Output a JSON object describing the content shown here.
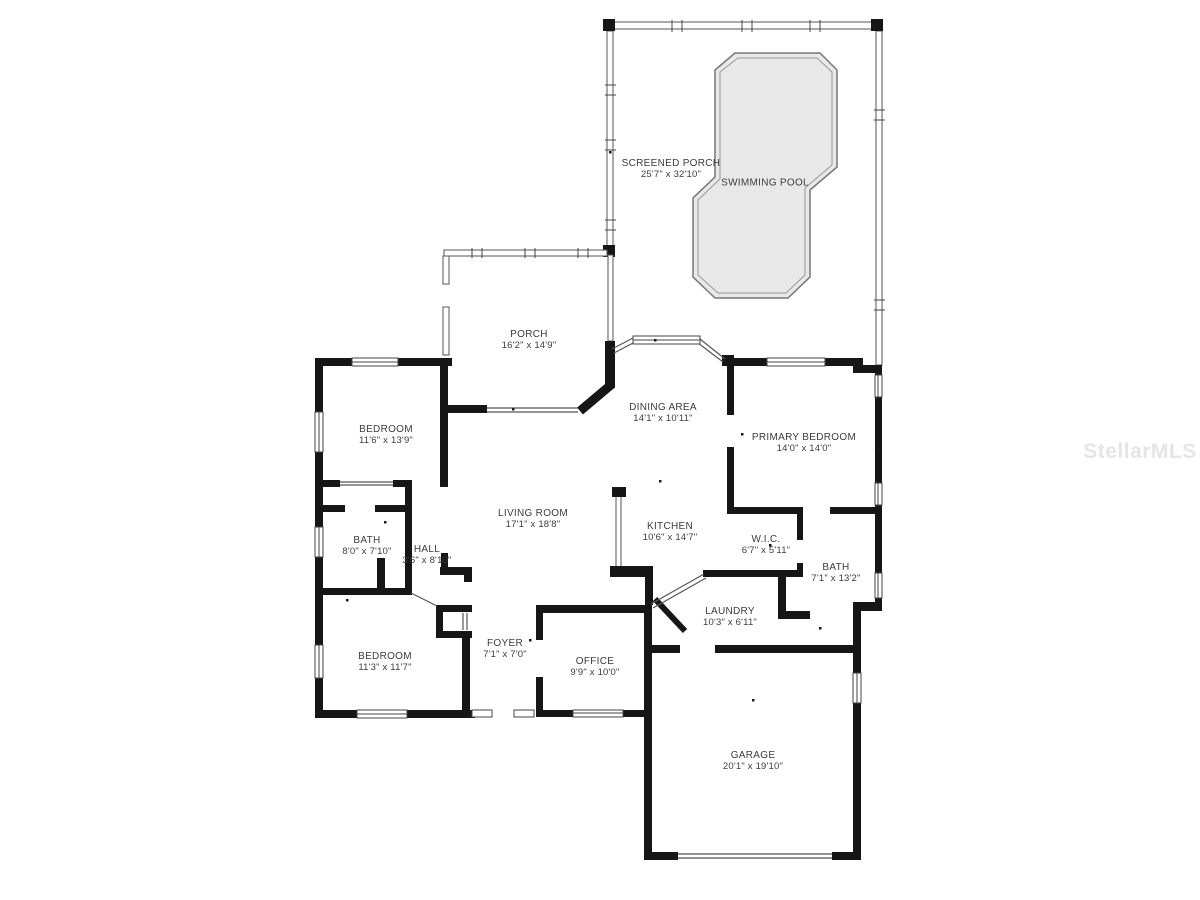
{
  "watermark": "StellarMLS",
  "colors": {
    "wall": "#161616",
    "pool_fill": "#e8e8e8",
    "label_text": "#3c3c3c"
  },
  "rooms": [
    {
      "name": "SCREENED PORCH",
      "dims": "25'7\" x 32'10\""
    },
    {
      "name": "SWIMMING POOL",
      "dims": ""
    },
    {
      "name": "PORCH",
      "dims": "16'2\" x 14'9\""
    },
    {
      "name": "DINING AREA",
      "dims": "14'1\" x 10'11\""
    },
    {
      "name": "PRIMARY BEDROOM",
      "dims": "14'0\" x 14'0\""
    },
    {
      "name": "BEDROOM",
      "dims": "11'6\" x 13'9\""
    },
    {
      "name": "LIVING ROOM",
      "dims": "17'1\" x 18'8\""
    },
    {
      "name": "KITCHEN",
      "dims": "10'6\" x 14'7\""
    },
    {
      "name": "BATH",
      "dims": "8'0\" x 7'10\""
    },
    {
      "name": "HALL",
      "dims": "3'6\" x 8'10\""
    },
    {
      "name": "W.I.C.",
      "dims": "6'7\" x 5'11\""
    },
    {
      "name": "BATH",
      "dims": "7'1\" x 13'2\""
    },
    {
      "name": "LAUNDRY",
      "dims": "10'3\" x 6'11\""
    },
    {
      "name": "BEDROOM",
      "dims": "11'3\" x 11'7\""
    },
    {
      "name": "FOYER",
      "dims": "7'1\" x 7'0\""
    },
    {
      "name": "OFFICE",
      "dims": "9'9\" x 10'0\""
    },
    {
      "name": "GARAGE",
      "dims": "20'1\" x 19'10\""
    }
  ]
}
